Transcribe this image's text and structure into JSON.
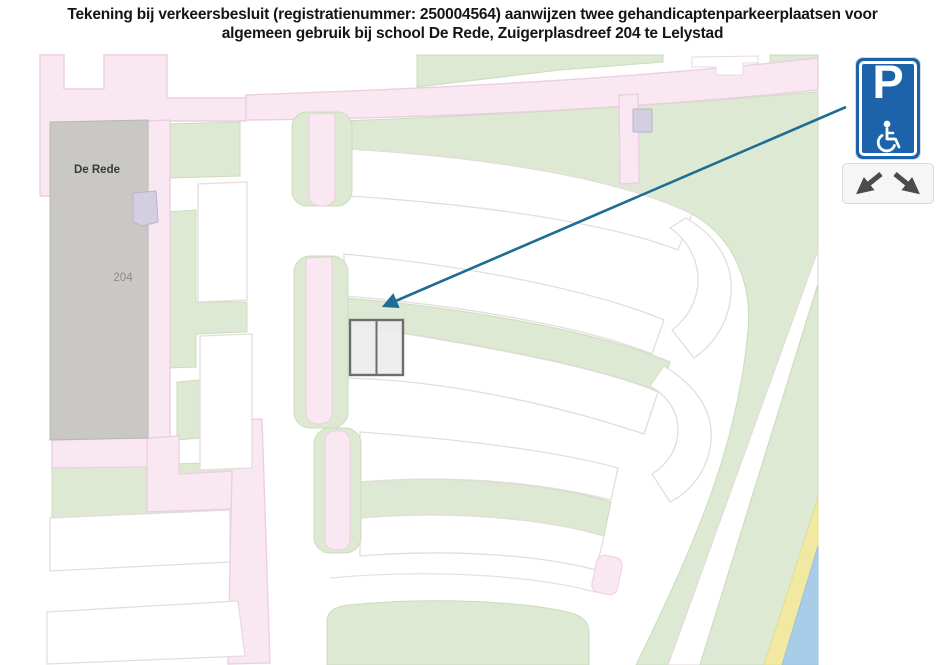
{
  "title": {
    "line1": "Tekening bij verkeersbesluit (registratienummer: 250004564) aanwijzen twee gehandicaptenparkeerplaatsen voor",
    "line2": "algemeen gebruik bij school De Rede, Zuigerplasdreef 204 te Lelystad"
  },
  "map": {
    "building_label": "De Rede",
    "house_number": "204",
    "colors": {
      "street_pink": "#f9e8f2",
      "street_pink_border": "#eccfe0",
      "grass_green": "#dde9d2",
      "grass_green_border": "#cbdcbd",
      "building_gray": "#c9c8c5",
      "annex_lavender": "#d3cfe0",
      "water_blue": "#a8cde8",
      "sand_yellow": "#f1e9a2",
      "row_outline": "#e5dcdc",
      "parking_space_fill": "#ececec",
      "parking_space_border": "#6d6d6d"
    }
  },
  "annotation": {
    "arrow_color": "#1f6d94",
    "sign": {
      "p_label": "P",
      "background_blue": "#1c63a9",
      "wheelchair_icon": "wheelchair-symbol",
      "arrows": [
        "down-left",
        "down-right"
      ]
    }
  }
}
